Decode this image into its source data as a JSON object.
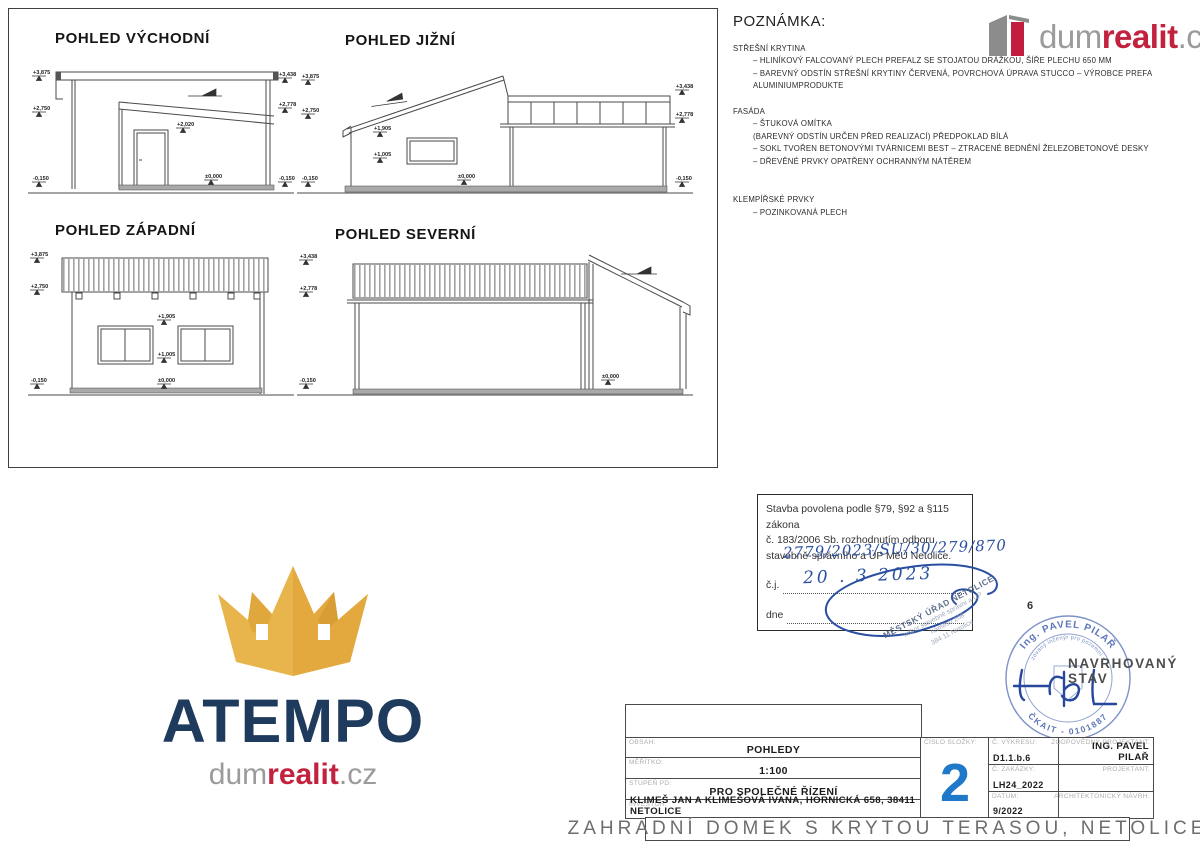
{
  "drawings": {
    "east": {
      "title": "POHLED VÝCHODNÍ",
      "markers": [
        "+3,875",
        "+2,750",
        "-0,150",
        "+3,438",
        "+2,778",
        "-0,150",
        "+2,020",
        "±0,000"
      ]
    },
    "south": {
      "title": "POHLED JIŽNÍ",
      "markers": [
        "+3,875",
        "+2,750",
        "-0,150",
        "+1,905",
        "+1,005",
        "±0,000",
        "+3,438",
        "+2,778",
        "-0,150"
      ]
    },
    "west": {
      "title": "POHLED ZÁPADNÍ",
      "markers": [
        "+3,875",
        "+2,750",
        "-0,150",
        "+1,905",
        "+1,005",
        "±0,000"
      ]
    },
    "north": {
      "title": "POHLED SEVERNÍ",
      "markers": [
        "+3,438",
        "+2,778",
        "-0,150",
        "±0,000"
      ]
    }
  },
  "notes": {
    "title": "POZNÁMKA:",
    "sections": [
      {
        "heading": "STŘEŠNÍ KRYTINA",
        "items": [
          "– HLINÍKOVÝ FALCOVANÝ PLECH PREFALZ SE STOJATOU DRÁŽKOU, ŠÍŘE PLECHU 650 MM",
          "– BAREVNÝ ODSTÍN STŘEŠNÍ KRYTINY ČERVENÁ, POVRCHOVÁ ÚPRAVA STUCCO – VÝROBCE PREFA ALUMINIUMPRODUKTE"
        ]
      },
      {
        "heading": "FASÁDA",
        "items": [
          "– ŠTUKOVÁ OMÍTKA",
          "(BAREVNÝ ODSTÍN URČEN PŘED REALIZACÍ) PŘEDPOKLAD BÍLÁ",
          "– SOKL TVOŘEN BETONOVÝMI TVÁRNICEMI BEST – ZTRACENÉ BEDNĚNÍ ŽELEZOBETONOVÉ DESKY",
          "– DŘEVĚNÉ PRVKY OPATŘENY OCHRANNÝM NÁTĚREM"
        ]
      },
      {
        "heading": "KLEMPÍŘSKÉ PRVKY",
        "items": [
          "– POZINKOVANÁ PLECH"
        ]
      }
    ]
  },
  "logo_top": {
    "dum": "dum",
    "realit": "realit",
    "cz": ".cz"
  },
  "atempo": {
    "name": "ATEMPO",
    "dum": "dum",
    "realit": "realit",
    "cz": ".cz"
  },
  "approval": {
    "line1": "Stavba povolena podle §79, §92 a §115 zákona",
    "line2": "č. 183/2006 Sb. rozhodnutím odboru",
    "line3": "stavebně-správního a ÚP MěÚ Netolice.",
    "cj_label": "č.j.",
    "cj_value": "2779/2023/SU/30/279/870",
    "dne_label": "dne",
    "dne_value": "20 . 3  2023"
  },
  "office_stamp": {
    "line1": "MĚSTSKÝ ÚŘAD NETOLICE",
    "line2": "odbor stavebně správní a ÚP",
    "line3": "náměstí 208",
    "line4": "384 11 Netolice"
  },
  "round_stamp": {
    "arc_top": "Ing. PAVEL PILAŘ",
    "arc_mid": "autorizovaný inženýr pro pozemní stavby",
    "arc_bottom": "ČKAIT - 0101887"
  },
  "status_label": "NAVRHOVANÝ STAV",
  "annotation_number": "6",
  "titleblock": {
    "obsah_label": "OBSAH:",
    "obsah": "POHLEDY",
    "meritko_label": "MĚŘÍTKO:",
    "meritko": "1:100",
    "stupen_label": "STUPEŇ PD:",
    "stupen": "PRO SPOLEČNÉ ŘÍZENÍ",
    "investor_label": "INVESTOR:",
    "investor": "KLIMEŠ JAN A KLIMEŠOVÁ IVANA, HORNICKÁ 658, 38411 NETOLICE",
    "cislo_slozky_label": "ČÍSLO SLOŽKY:",
    "cislo_slozky": "2",
    "c_vykresu_label": "Č. VÝKRESU:",
    "c_vykresu": "D1.1.b.6",
    "c_zakazky_label": "Č. ZAKÁZKY:",
    "c_zakazky": "LH24_2022",
    "datum_label": "DATUM:",
    "datum": "9/2022",
    "zodp_label": "ZODPOVĚDNÝ PROJEKTANT:",
    "zodp": "ING. PAVEL PILAŘ",
    "projektant_label": "PROJEKTANT:",
    "arch_label": "ARCHITEKTONICKÝ NÁVRH:",
    "project_title": "ZAHRADNÍ DOMEK S KRYTOU TERASOU, NETOLICE"
  },
  "colors": {
    "accent_blue": "#2079c8",
    "brand_red": "#c2223e",
    "brand_navy": "#1e3a5c",
    "brand_gold": "#e8b54c",
    "stamp_blue": "#5d77ba",
    "hand_blue": "#2b4fa0"
  }
}
